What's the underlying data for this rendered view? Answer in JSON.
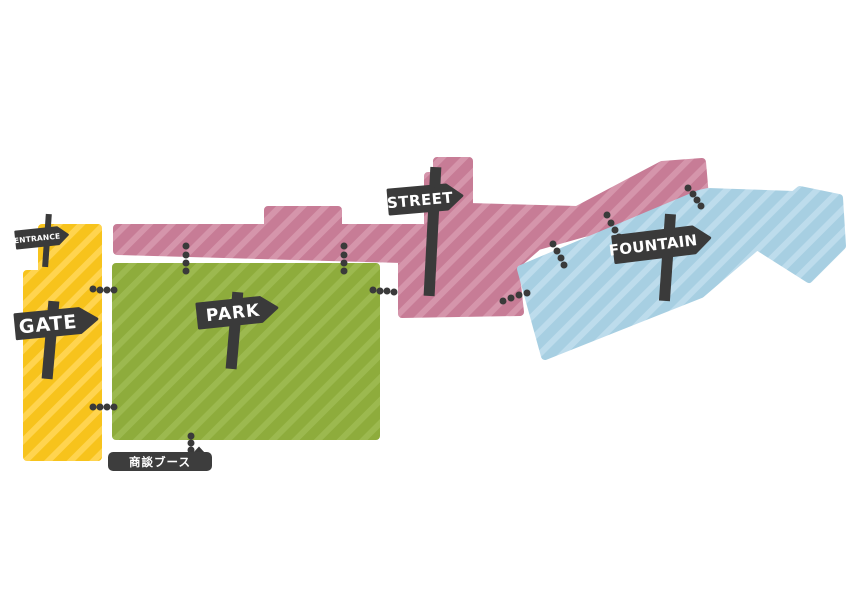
{
  "map": {
    "title": "venue-map",
    "background": "#FFFFFF",
    "sign_color": "#3A3A3A",
    "dot_color": "#3A3A3A",
    "entrance": {
      "label": "ENTRANCE"
    },
    "booth": {
      "label": "商談ブース",
      "bg": "#3D3D3D",
      "text_color": "#FFFFFF"
    },
    "zones": [
      {
        "id": "gate",
        "label": "GATE",
        "color_base": "#F7C31C",
        "color_stripe": "#FFD44F"
      },
      {
        "id": "park",
        "label": "PARK",
        "color_base": "#8EAC3C",
        "color_stripe": "#9CB94F"
      },
      {
        "id": "street",
        "label": "STREET",
        "color_base": "#C77C96",
        "color_stripe": "#D595AB"
      },
      {
        "id": "fountain",
        "label": "FOUNTAIN",
        "color_base": "#A7CFE2",
        "color_stripe": "#BDDCEC"
      }
    ]
  }
}
